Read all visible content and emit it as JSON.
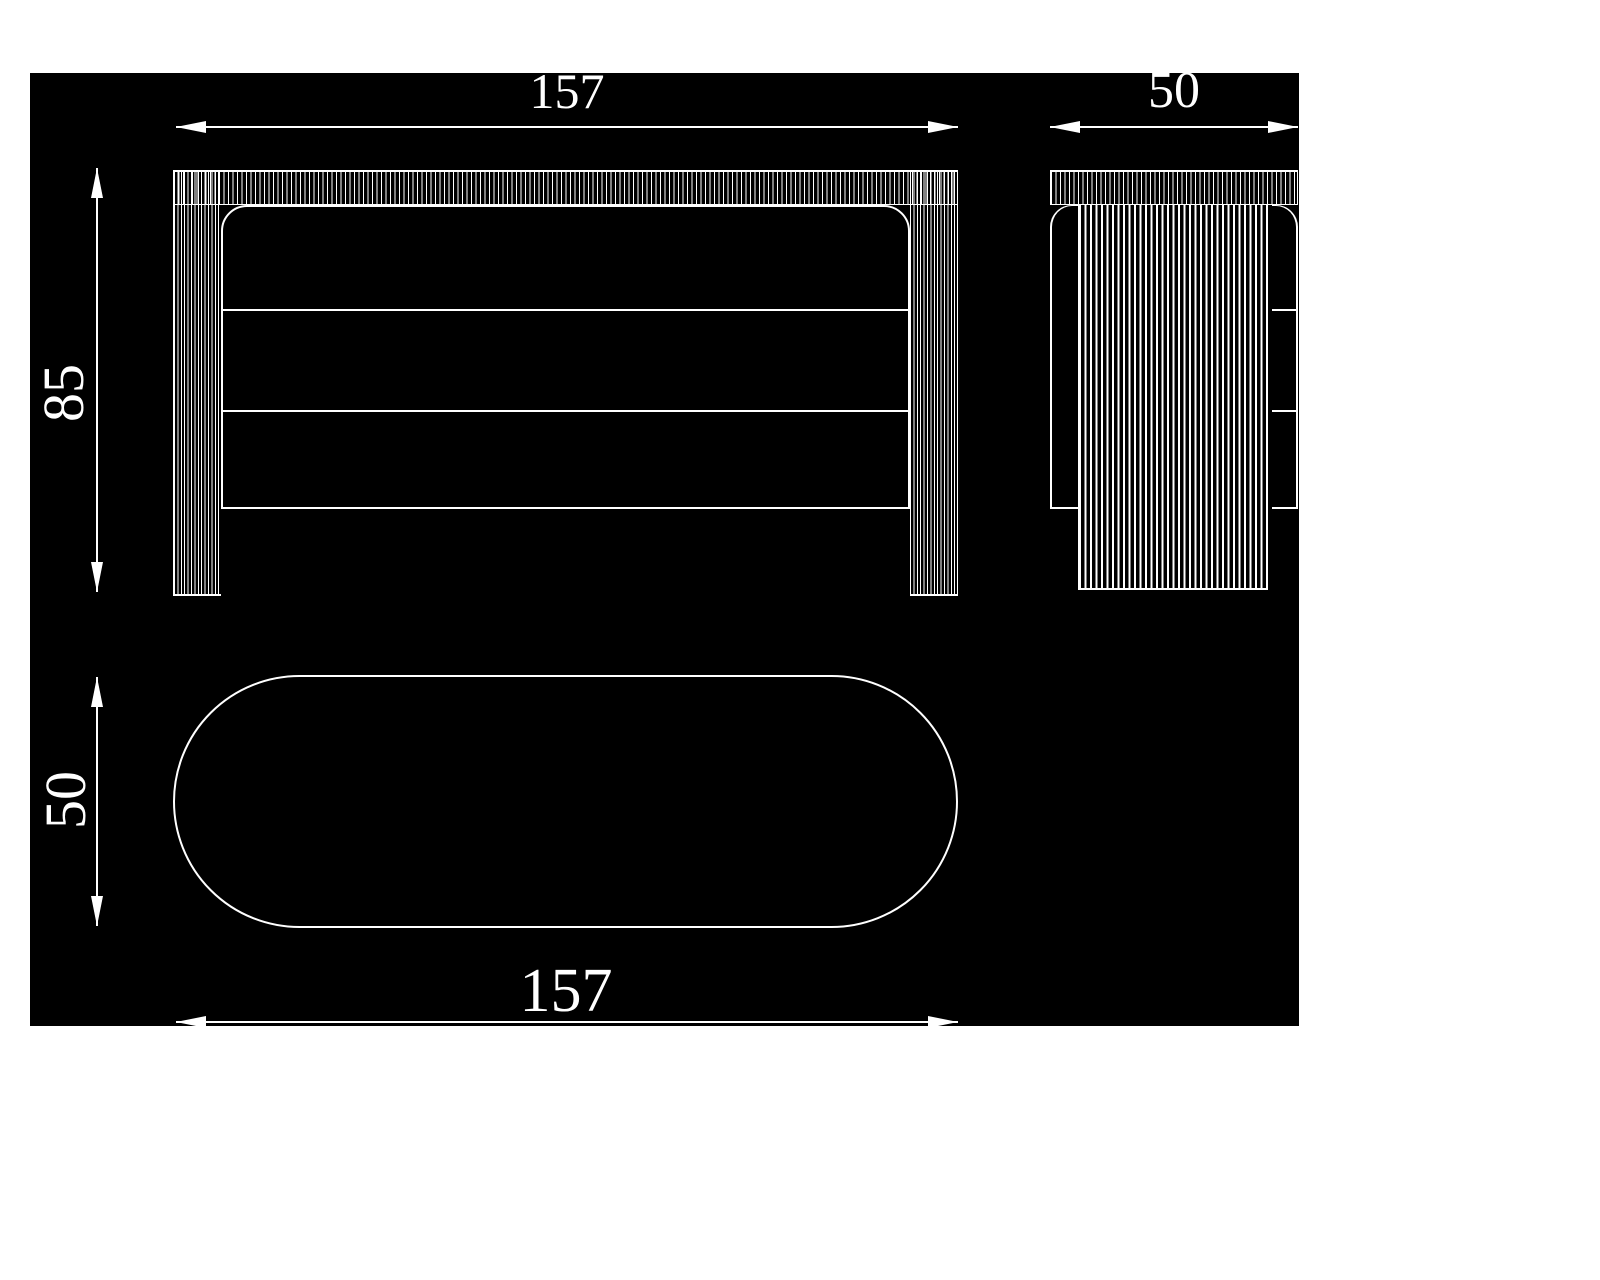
{
  "canvas": {
    "background": "#000000",
    "page_background": "#ffffff",
    "line_color": "#ffffff"
  },
  "dimensions": {
    "front_width": "157",
    "front_height": "85",
    "side_depth": "50",
    "top_width": "157",
    "top_depth": "50"
  }
}
